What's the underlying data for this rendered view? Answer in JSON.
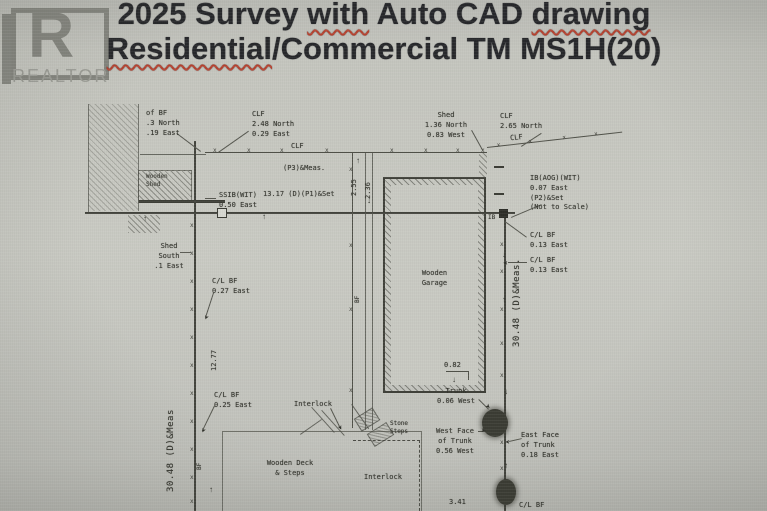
{
  "header": {
    "line1_pre": "2025 Survey ",
    "line1_sq1": "with",
    "line1_mid": " Auto CAD ",
    "line1_sq2": "drawing",
    "line2_sq": "Residential",
    "line2_rest": "/Commercial TM MS1H(20)",
    "logo_letter": "R",
    "logo_text": "REALTOR"
  },
  "colors": {
    "background": "#c4c5be",
    "ink": "#35362f",
    "title": "#26272a",
    "squiggle": "#b5412f"
  },
  "survey": {
    "fence_mark": "x",
    "arrow_up": "↑",
    "arrow_down": "↓",
    "arrow_head": "➤",
    "annotations": {
      "nw_bf": "of BF\n.3 North\n.19 East",
      "nw_clf": "CLF\n2.48 North\n0.29 East",
      "clf": "CLF",
      "p3_meas": "(P3)&Meas.",
      "wooden_shed": "Wooden\nShed",
      "ssib": "SSIB(WIT)\n0.50 East",
      "north_dim": "13.17  (D)(P1)&Set",
      "dim_2_55": "2.55",
      "dim_2_36": "2.36",
      "ne_shed": "Shed\n1.36 North\n0.83 West",
      "ne_clf": "CLF\n2.65 North",
      "ib_note": "IB(AOG)(WIT)\n0.07 East\n(P2)&Set\n(Not to Scale)",
      "ib_mark": "IB",
      "clbf_013_a": "C/L BF\n0.13 East",
      "clbf_013_b": "C/L BF\n0.13 East",
      "east_dim": "30.48 (D)&Meas.",
      "shed_south": "Shed\nSouth\n.1 East",
      "clbf_027": "C/L BF\n0.27 East",
      "dim_12_77": "12.77",
      "clbf_025": "C/L BF\n0.25 East",
      "west_dim": "30.48 (D)&Meas",
      "bf": "BF",
      "interlock": "Interlock",
      "stone_steps": "Stone\nSteps",
      "wooden_deck": "Wooden Deck\n& Steps",
      "garage": "Wooden\nGarage",
      "garage_off": "0.82",
      "trunk_west": "Trunk\n0.06 West",
      "west_face": "West Face\nof Trunk\n0.56 West",
      "east_face": "East Face\nof Trunk\n0.18 East",
      "dim_3_41": "3.41",
      "clbf_bottom": "C/L BF"
    }
  }
}
